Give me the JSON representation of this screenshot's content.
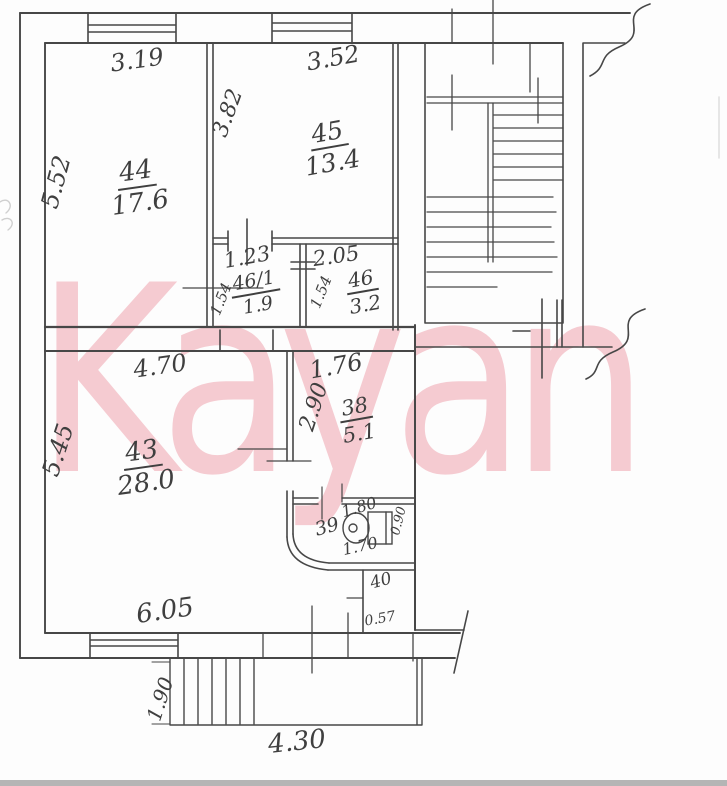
{
  "watermark": {
    "text": "Kayan",
    "color": "#f5cbd1"
  },
  "floor_plan": {
    "upper_unit": {
      "room_44": {
        "number": "44",
        "area": "17.6",
        "width": "3.19",
        "height": "5.52"
      },
      "room_45": {
        "number": "45",
        "area": "13.4",
        "width": "3.52",
        "height": "3.82"
      },
      "room_46_1": {
        "number": "46/1",
        "area": "1.9",
        "width": "1.23",
        "height": "1.54"
      },
      "room_46": {
        "number": "46",
        "area": "3.2",
        "width": "2.05",
        "height": "1.54"
      }
    },
    "lower_unit": {
      "room_43": {
        "number": "43",
        "area": "28.0",
        "width_top": "4.70",
        "width_bottom": "6.05",
        "height": "5.45"
      },
      "room_38": {
        "number": "38",
        "area": "5.1",
        "width": "1.76",
        "height": "2.90"
      },
      "room_39": {
        "number": "39",
        "width_top": "1.80",
        "width_bottom": "1.70",
        "depth": "0.90"
      },
      "room_40": {
        "number": "40",
        "width": "0.57"
      }
    },
    "porch": {
      "depth": "1.90",
      "width": "4.30"
    }
  }
}
